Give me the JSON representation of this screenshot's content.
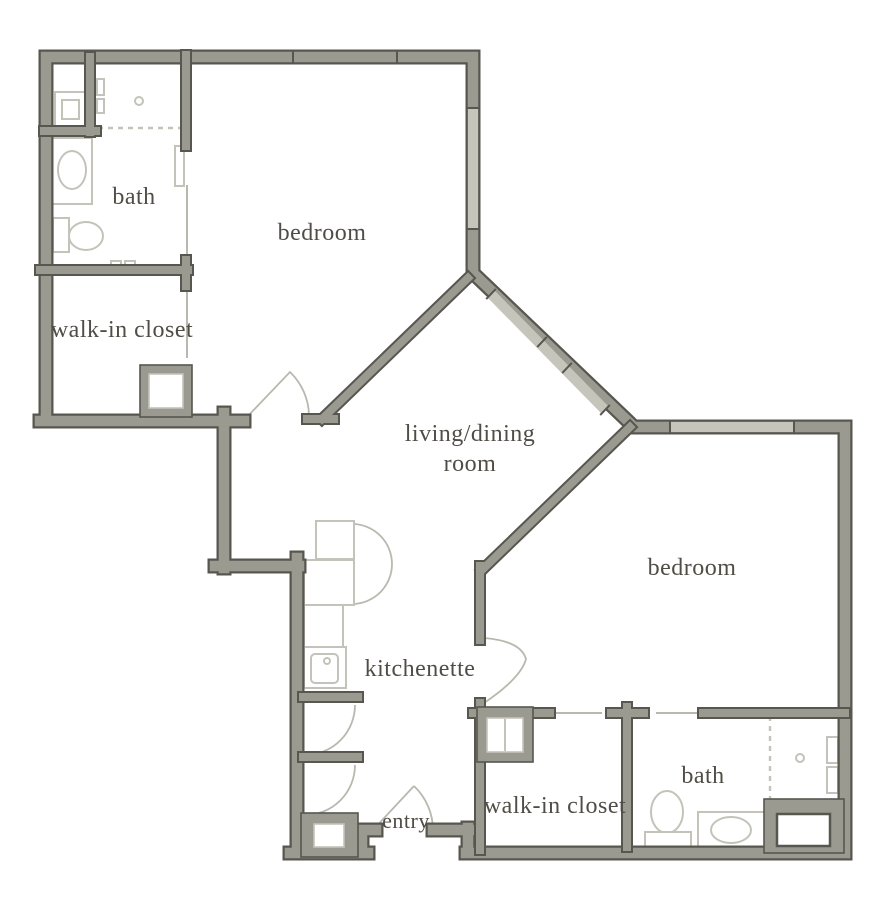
{
  "floor_plan": {
    "kind": "two-bedroom apartment floor plan",
    "rooms": {
      "bath_left": "bath",
      "bedroom_top": "bedroom",
      "walk_in_closet_left": "walk-in closet",
      "living_dining_line1": "living/dining",
      "living_dining_line2": "room",
      "kitchenette": "kitchenette",
      "entry": "entry",
      "walk_in_closet_right": "walk-in closet",
      "bath_right": "bath",
      "bedroom_right": "bedroom"
    },
    "colors": {
      "wall_fill": "#9b9a91",
      "wall_edge": "#57564f",
      "window_fill": "#c6c5bb",
      "fixture_line": "#c4c3ba",
      "door_arc": "#b9b8af",
      "label_text": "#4f4d45",
      "background": "#ffffff"
    }
  }
}
